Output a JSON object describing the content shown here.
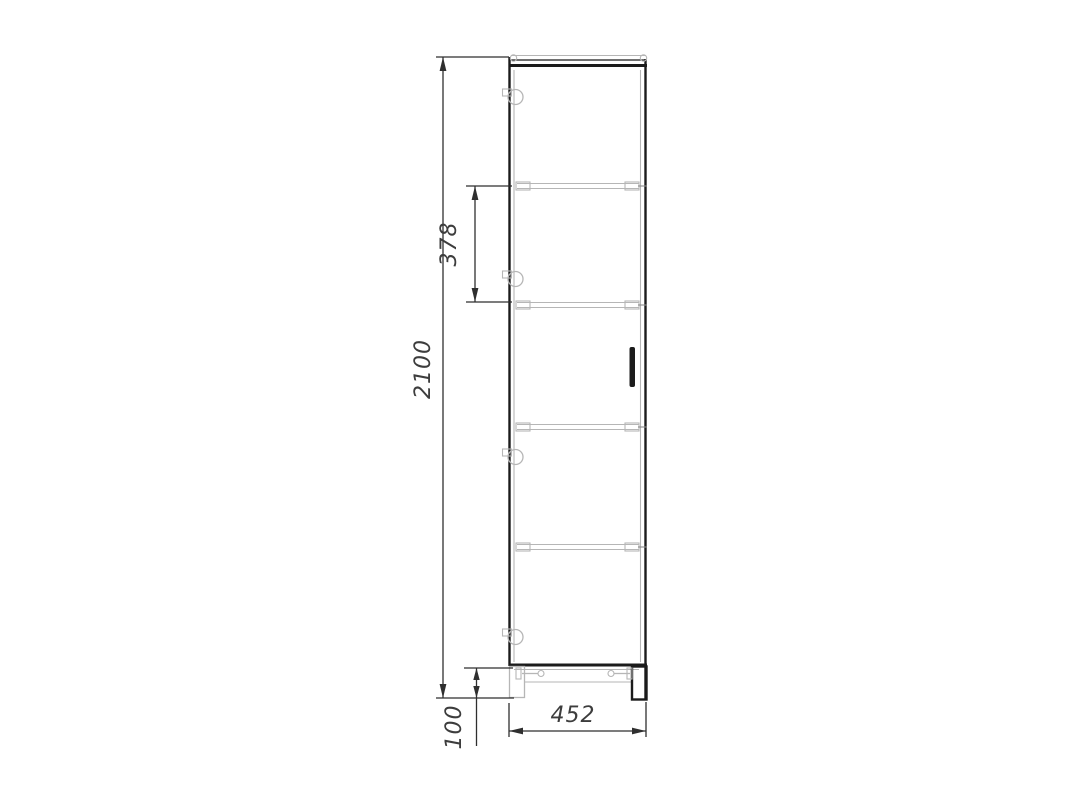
{
  "diagram": {
    "type": "furniture_dimension_drawing",
    "view": "front",
    "object_name": "tall-single-door-cabinet",
    "dimensions": [
      {
        "id": "overall-height",
        "label": "2100",
        "orientation": "vertical"
      },
      {
        "id": "shelf-spacing",
        "label": "378",
        "orientation": "vertical"
      },
      {
        "id": "plinth-height",
        "label": "100",
        "orientation": "vertical"
      },
      {
        "id": "overall-width",
        "label": "452",
        "orientation": "horizontal"
      }
    ],
    "features": {
      "shelf_count": 4,
      "hinge_count": 4,
      "handle": "vertical-bar-right-side",
      "leg_count": 2
    }
  },
  "colors": {
    "background": "#ffffff",
    "outline": "#1b1b1b",
    "hidden": "#b6b6b6",
    "dim": "#2f2f2f",
    "text": "#3d3d3d"
  }
}
